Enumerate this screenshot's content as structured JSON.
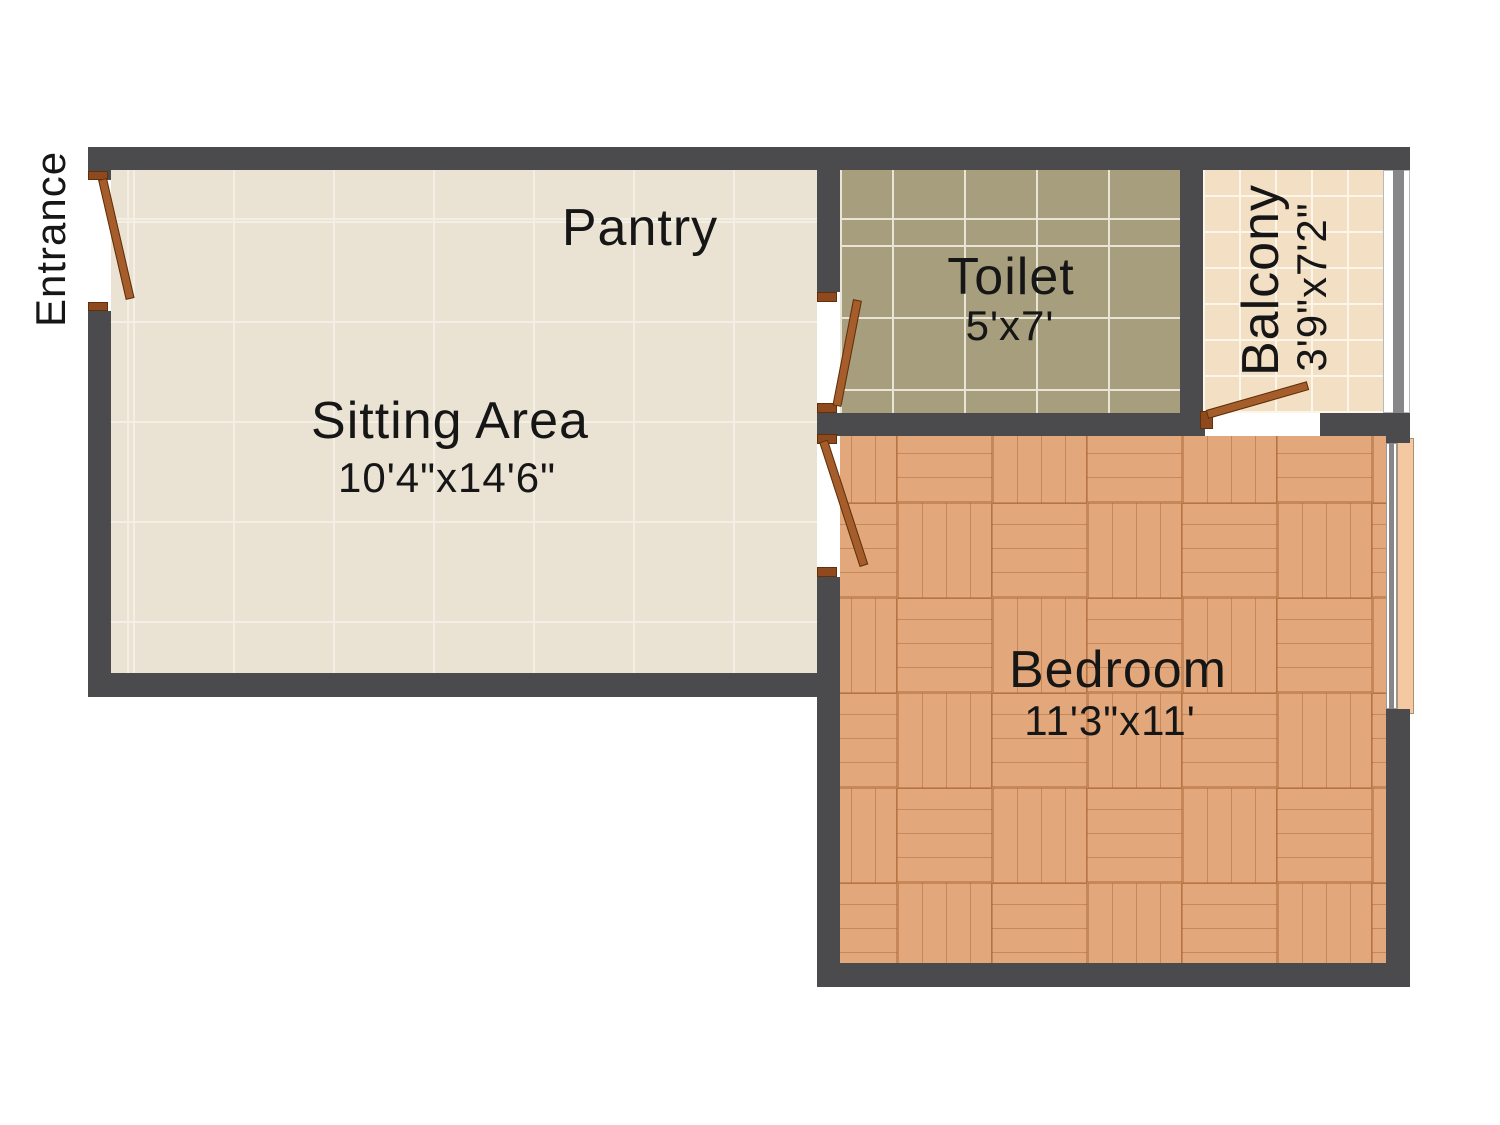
{
  "plan": {
    "entrance_label": "Entrance",
    "rooms": {
      "pantry": {
        "label": "Pantry"
      },
      "sitting": {
        "label": "Sitting Area",
        "dims": "10'4\"x14'6\""
      },
      "toilet": {
        "label": "Toilet",
        "dims": "5'x7'"
      },
      "balcony": {
        "label": "Balcony",
        "dims": "3'9\"x7'2\""
      },
      "bedroom": {
        "label": "Bedroom",
        "dims": "11'3\"x11'"
      }
    }
  },
  "colors": {
    "wall": "#4b4b4e",
    "sittingFloor": "#eae3d4",
    "sittingGrout": "#f4efe4",
    "toiletFloor": "#a79e7d",
    "toiletGrout": "#e9e5d6",
    "balconyFloor": "#f2dfc4",
    "balconyGrout": "#fbf5ea",
    "parquetBase": "#e2a87b",
    "parquetLine": "rgba(155,85,35,0.38)",
    "door": "#a65d2c",
    "doorSill": "#8e4a1e",
    "doorBorder": "#5f3009",
    "windowSill": "#f4c9a2",
    "railGray": "#87878a"
  }
}
